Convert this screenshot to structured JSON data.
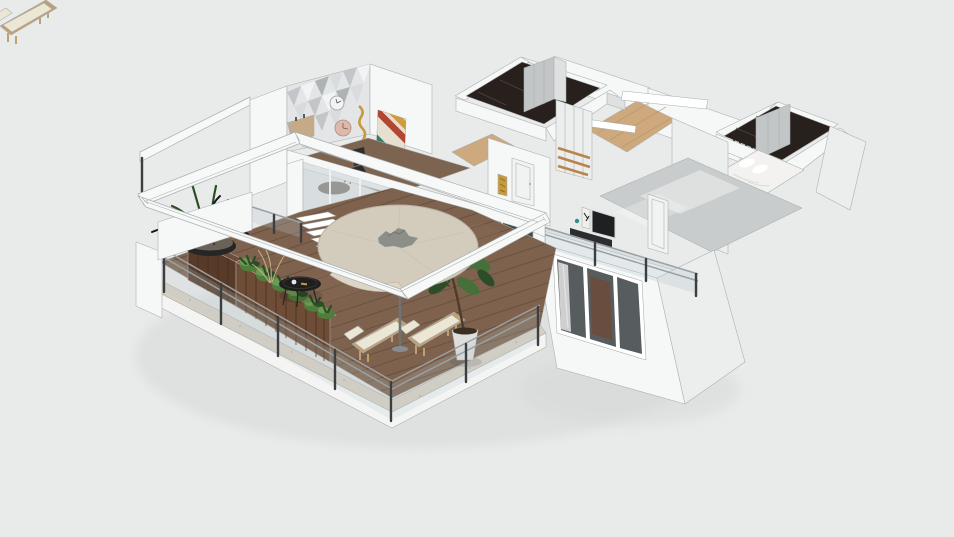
{
  "canvas": {
    "width": 954,
    "height": 537,
    "description": "3D isometric dollhouse render of an apartment floor plan with a large wrap-around wooden terrace, roofless top-down three-quarter view on a plain light gray background"
  },
  "colors": {
    "background": "#e9eaea",
    "outline": "#a9aeae",
    "wall_lit": "#f6f7f7",
    "wall_mid": "#eceded",
    "wall_shade": "#dfe1e1",
    "plinth_white": "#f4f4f3",
    "ground_shadow": "#d7d8d8",
    "stone_border": "#d6cfc2",
    "stone_speckle": "#b4ab9b",
    "deck_wood": "#7e624e",
    "deck_plank_line": "#5f4938",
    "oak_floor": "#cda97d",
    "oak_line": "#b48f63",
    "office_floor": "#7c6450",
    "dark_marble": "#27201c",
    "marble_vein": "#58493f",
    "glossy_floor": "#c8cccc",
    "wardrobe_gray": "#c2c6c7",
    "glass_light": "#cdd6d8",
    "glass_dark": "#41464a",
    "glass_tint": "#b7c9cf",
    "mullion_white": "#f2f3f3",
    "door_white": "#f1f2f2",
    "rail_silver": "#9ba1a3",
    "post_dark": "#3c3f42",
    "planter_wood": "#6e4c36",
    "planter_wood_dark": "#573a28",
    "planter_wood_light": "#82604a",
    "planter_seam": "#4a3122",
    "plant_green": "#4f7d3c",
    "plant_green_light": "#6b9b52",
    "plant_dark": "#2d4d28",
    "driftwood": "#161616",
    "bowl_black": "#262626",
    "table_black": "#1e1e1e",
    "lounger_wood": "#bfa073",
    "cushion": "#ece6d5",
    "tree_green": "#46703a",
    "pot_white": "#dededc",
    "bed_white": "#f3f2f0",
    "bed_shadow": "#d8d5d1",
    "shelf_wood": "#b9854f",
    "art_gold": "#c69b3d",
    "chair_black": "#2b2d2e",
    "tv_dark": "#1f2022",
    "parasol": "#d3ccbc",
    "parasol_edge": "#b8b0a0",
    "parasol_vent": "#8b8e89",
    "pole_gray": "#6f7376",
    "beam_white": "#f7f8f8",
    "twig_tan": "#c9b089"
  },
  "scene": {
    "camera": "elevated three-quarter isometric view, dollhouse style without roof",
    "background": "plain light gray, no UI chrome",
    "areas": [
      {
        "id": "terrace",
        "label": "wrap-around terrace",
        "floor": "dark wood deck planks with travertine border",
        "items": [
          "white pergola frame",
          "round beige parasol with gray vent",
          "two wooden sun loungers with white cushions",
          "potted tree in white planter",
          "rustic wooden planter boxes with green shrubs",
          "black bowl planter with driftwood and blades",
          "round black coffee table",
          "glass railing with dark posts and steel handrails",
          "white steps to interior",
          "dry twig decor"
        ]
      },
      {
        "id": "office",
        "label": "studio room",
        "floor": "walnut wood",
        "items": [
          "geometric triangle accent wall",
          "two round wall clocks",
          "gold wall art",
          "colorful chevron artwork leaning on wall",
          "black desk chair",
          "dark round table",
          "tan sideboard",
          "sliding glass door to terrace"
        ]
      },
      {
        "id": "living",
        "label": "living room",
        "items": [
          "dark sliding glass doors facing terrace"
        ]
      },
      {
        "id": "hallway",
        "label": "hallway",
        "floor": "light oak",
        "items": [
          "white interior door",
          "gold mosaic art panel",
          "tall white shelving unit with wood shelves"
        ]
      },
      {
        "id": "closet",
        "label": "walk-in closet",
        "floor": "black marble",
        "items": [
          "light gray wardrobe panels"
        ]
      },
      {
        "id": "kitchen",
        "label": "kitchen nook",
        "floor": "light oak",
        "items": [
          "floating white counter slabs",
          "dark mirror panel"
        ]
      },
      {
        "id": "bedroom2",
        "label": "second bedroom / closet room",
        "floor": "black marble",
        "items": [
          "gray wardrobe",
          "hanging clothes",
          "white bed with pillows"
        ]
      },
      {
        "id": "bedroom1",
        "label": "main bedroom",
        "floor": "glossy gray",
        "items": [
          "white door",
          "TV with framed art and teal vase on dark console",
          "rear balcony with glass railing",
          "triple-pane window"
        ]
      }
    ]
  }
}
